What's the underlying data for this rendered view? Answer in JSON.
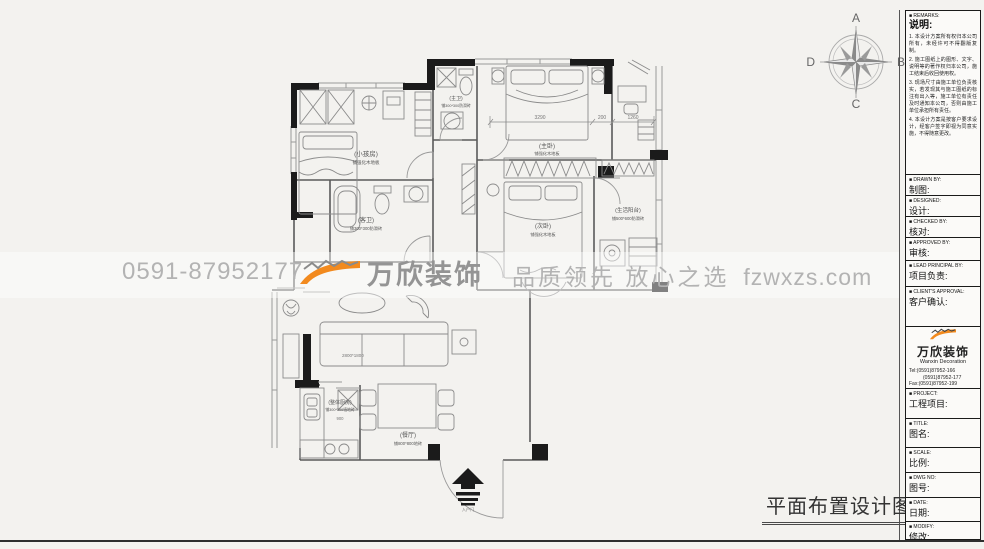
{
  "page": {
    "bottom_title": "平面布置设计图"
  },
  "watermark": {
    "phone": "0591-87952177",
    "brand": "万欣装饰",
    "slogan": "品质领先 放心之选",
    "site": "fzwxzs.com",
    "accent_color": "#f28a1e",
    "gray_color": "#b3b3b3"
  },
  "compass": {
    "north": "A",
    "east": "B",
    "south": "C",
    "west": "D"
  },
  "plan": {
    "rooms": {
      "kids": {
        "name": "(小孩房)",
        "floor": "铺强化木地板"
      },
      "master_bath": {
        "name": "(主卫)",
        "floor": "铺300*300防滑砖"
      },
      "master": {
        "name": "(主卧)",
        "floor": "铺强化木地板"
      },
      "second": {
        "name": "(次卧)",
        "floor": "铺强化木地板"
      },
      "guest_bath": {
        "name": "(客卫)",
        "floor": "铺300*300防滑砖"
      },
      "service_balcony": {
        "name": "(生活阳台)",
        "floor": "铺500*600防滑砖"
      },
      "kitchen": {
        "name": "(整体厨房)",
        "floor": "铺300*300墙地砖"
      },
      "dining": {
        "name": "(餐厅)",
        "floor": "铺800*800地砖"
      }
    },
    "dims": {
      "master_width": "3290",
      "wall": "200",
      "nook": "1260",
      "sofa": "2800*1800",
      "kitchen": "900"
    },
    "entry": "入户门"
  },
  "titleblock": {
    "remarks": {
      "en": "■ REMARKS:",
      "zh": "说明:",
      "items": [
        "1. 本设计方案所有权归本公司所有，未经许可不得翻版复制。",
        "2. 施工图纸上的图形、文字、说明等的著作权归本公司，施工结束后收回使用权。",
        "3. 现场尺寸由施工单位负责核实，若发现其与施工图纸的标注有出入等，施工单位有责任及时通知本公司，否则由施工单位承担所有责任。",
        "4. 本设计方案是按客户要求设计，经客户签字即视为同意实施，不得随意更改。"
      ]
    },
    "fields": [
      {
        "en": "■ DRAWN BY:",
        "zh": "制图:"
      },
      {
        "en": "■ DESIGNED:",
        "zh": "设计:"
      },
      {
        "en": "■ CHECKED BY:",
        "zh": "核对:"
      },
      {
        "en": "■ APPROVED BY:",
        "zh": "审核:"
      },
      {
        "en": "■ LEAD PRINCIPAL BY:",
        "zh": "项目负责:"
      },
      {
        "en": "■ CLIENT'S APPROVAL:",
        "zh": "客户确认:"
      }
    ],
    "logo": {
      "cn": "万欣装饰",
      "en": "Wanxin Decoration",
      "tel1": "Tel:(0591)87952-166",
      "tel2": "(0591)87952-177",
      "fax": "Fax:(0591)87952-199",
      "web": "Web:WWW.fzwxzs.com"
    },
    "fields2": [
      {
        "en": "■ PROJECT:",
        "zh": "工程项目:"
      },
      {
        "en": "■ TITLE:",
        "zh": "图名:"
      },
      {
        "en": "■ SCALE:",
        "zh": "比例:"
      },
      {
        "en": "■ DWG NO:",
        "zh": "图号:"
      },
      {
        "en": "■ DATE:",
        "zh": "日期:"
      },
      {
        "en": "■ MODIFY:",
        "zh": "修改:"
      }
    ]
  }
}
